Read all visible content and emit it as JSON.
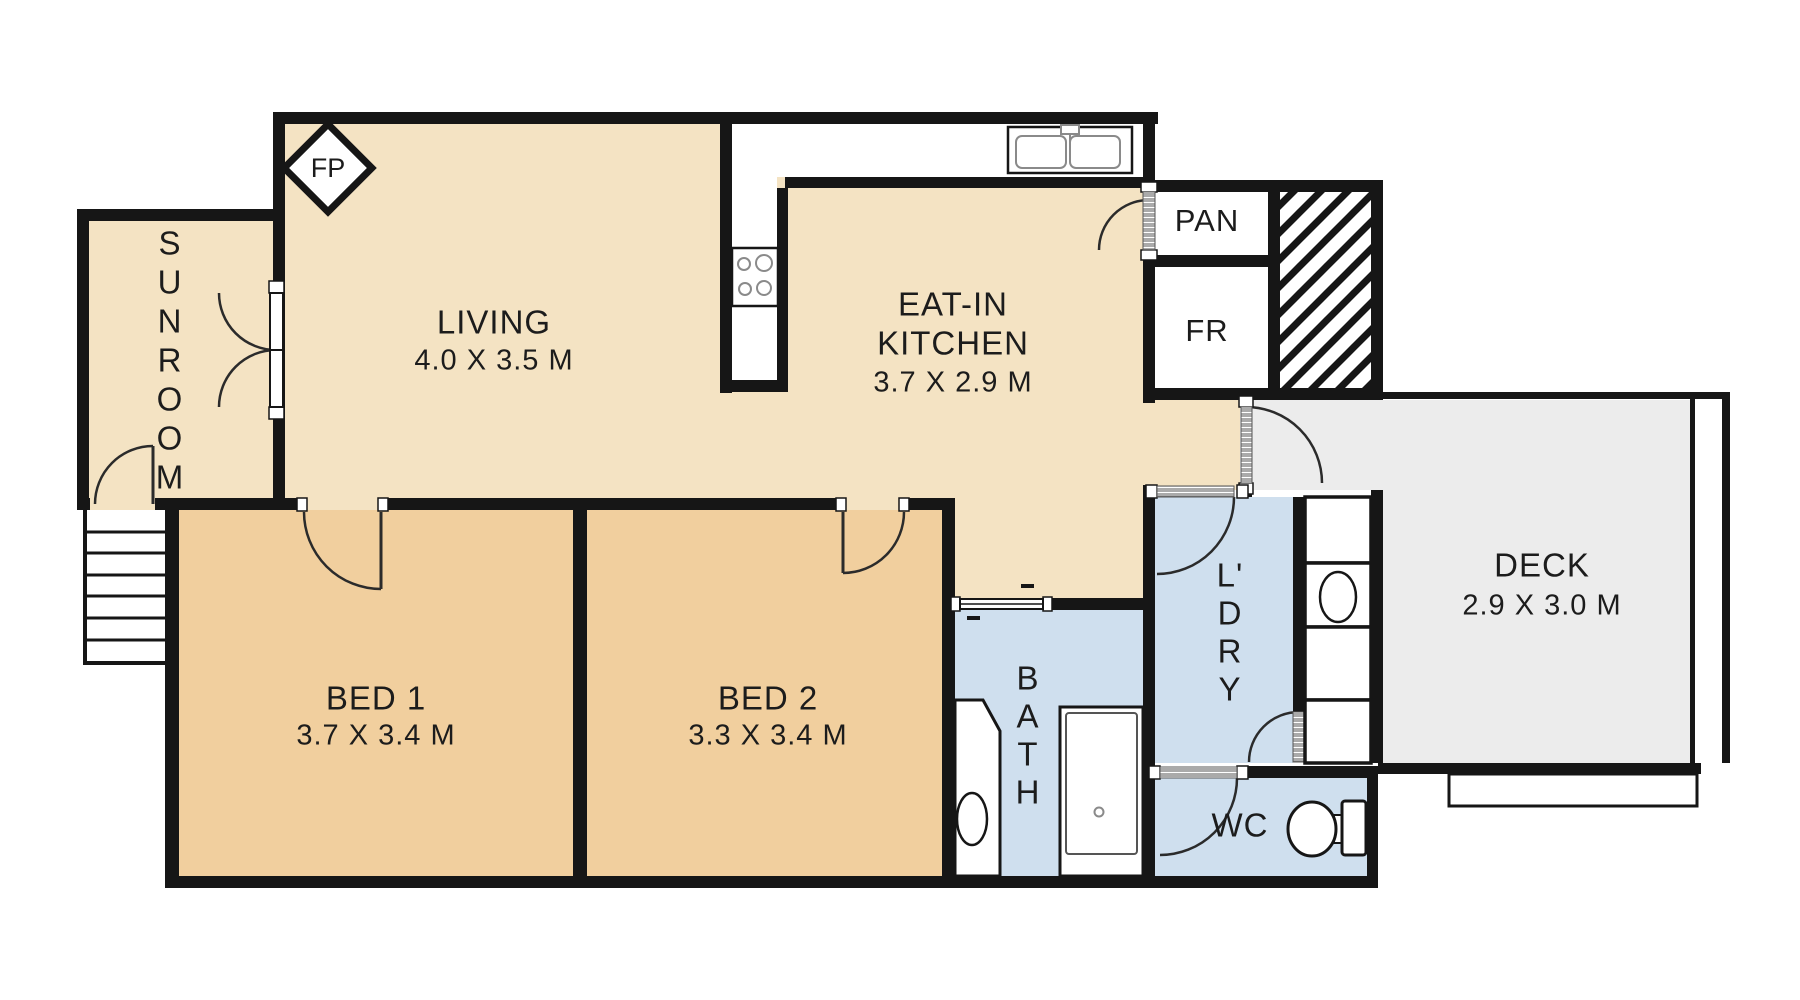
{
  "title": "Apartment floor plan",
  "colors": {
    "wall": "#161616",
    "cream": "#f4e3c3",
    "bedroom": "#f1cf9e",
    "wet": "#cfdfee",
    "deck": "#ececec"
  },
  "rooms": {
    "sunroom": {
      "name": "SUNROOM",
      "letters": [
        "S",
        "U",
        "N",
        "R",
        "O",
        "O",
        "M"
      ]
    },
    "living": {
      "name": "LIVING",
      "dims": "4.0 X 3.5 M"
    },
    "kitchen": {
      "name_line1": "EAT-IN",
      "name_line2": "KITCHEN",
      "dims": "3.7 X 2.9 M"
    },
    "pantry": {
      "name": "PAN"
    },
    "fridge": {
      "name": "FR"
    },
    "deck": {
      "name": "DECK",
      "dims": "2.9 X 3.0 M"
    },
    "bed1": {
      "name": "BED 1",
      "dims": "3.7 X 3.4 M"
    },
    "bed2": {
      "name": "BED 2",
      "dims": "3.3 X 3.4 M"
    },
    "bath": {
      "name": "BATH",
      "letters": [
        "B",
        "A",
        "T",
        "H"
      ]
    },
    "laundry": {
      "name": "L'DRY",
      "letters": [
        "L'",
        "D",
        "R",
        "Y"
      ]
    },
    "wc": {
      "name": "WC"
    },
    "fireplace": {
      "label": "FP"
    }
  },
  "icons": {
    "fireplace": "fireplace-diamond-icon",
    "stove": "stove-burners-icon",
    "sink": "double-sink-icon",
    "vanity": "vanity-basin-icon",
    "bathtub": "bathtub-icon",
    "toilet": "toilet-icon",
    "laundry_tub": "laundry-tub-icon",
    "stairs": "stairs-icon",
    "hatch": "hatched-void-icon"
  }
}
